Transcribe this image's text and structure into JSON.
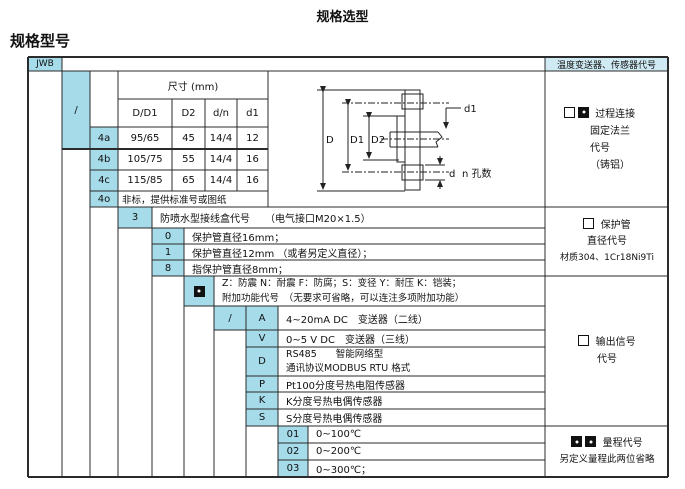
{
  "page": {
    "title": "规格选型",
    "heading": "规格型号"
  },
  "header": {
    "model": "JWB",
    "right_label": "温度变送器、传感器代号"
  },
  "size_table": {
    "title": "尺寸 (mm)",
    "slash": "/",
    "columns": [
      "D/D1",
      "D2",
      "d/n",
      "d1"
    ],
    "rows": [
      {
        "code": "4a",
        "vals": [
          "95/65",
          "45",
          "14/4",
          "12"
        ]
      },
      {
        "code": "4b",
        "vals": [
          "105/75",
          "55",
          "14/4",
          "16"
        ]
      },
      {
        "code": "4c",
        "vals": [
          "115/85",
          "65",
          "14/4",
          "16"
        ]
      },
      {
        "code": "4o",
        "note": "非标，提供标准号或图纸"
      }
    ]
  },
  "diagram": {
    "D": "D",
    "D1": "D1",
    "D2": "D2",
    "d1": "d1",
    "d": "d",
    "n": "n 孔数"
  },
  "junction_box": {
    "code": "3",
    "label": "防喷水型接线盒代号　　（电气接口M20×1.5）"
  },
  "protection": {
    "rows": [
      {
        "code": "0",
        "label": "保护管直径16mm；"
      },
      {
        "code": "1",
        "label": "保护管直径12mm （或者另定义直径）；"
      },
      {
        "code": "8",
        "label": "指保护管直径8mm；"
      }
    ]
  },
  "extra_func": {
    "line1": "Z：防震 N：耐震 F：防腐；S：变径 Y：耐压 K：铠装；",
    "line2": "附加功能代号　（无要求可省略，可以连注多项附加功能）"
  },
  "output": {
    "slash": "/",
    "rows": [
      {
        "code": "A",
        "label": "4~20mA DC　变送器（二线）"
      },
      {
        "code": "V",
        "label": "0~5 V DC　变送器（三线）"
      },
      {
        "code": "D",
        "label": "RS485　　智能网络型",
        "label2": "通讯协议MODBUS RTU 格式"
      },
      {
        "code": "P",
        "label": "Pt100分度号热电阻传感器"
      },
      {
        "code": "K",
        "label": "K分度号热电偶传感器"
      },
      {
        "code": "S",
        "label": "S分度号热电偶传感器"
      }
    ]
  },
  "range": {
    "rows": [
      {
        "code": "01",
        "label": "0~100℃"
      },
      {
        "code": "02",
        "label": "0~200℃"
      },
      {
        "code": "03",
        "label": "0~300℃；"
      }
    ]
  },
  "panel": {
    "process": {
      "line1": "过程连接",
      "line2": "固定法兰",
      "line3": "代号",
      "line4": "（铸铝）"
    },
    "tube": {
      "line1": "保护管",
      "line2": "直径代号",
      "line3": "材质304、1Cr18Ni9Ti"
    },
    "signal": {
      "line1": "输出信号",
      "line2": "代号"
    },
    "range": {
      "line1": "量程代号",
      "line2": "另定义量程此两位省略"
    }
  },
  "colors": {
    "cell_highlight": "#a6dbea",
    "band_highlight": "#cfeaf3",
    "grid": "#2b2b2b"
  }
}
